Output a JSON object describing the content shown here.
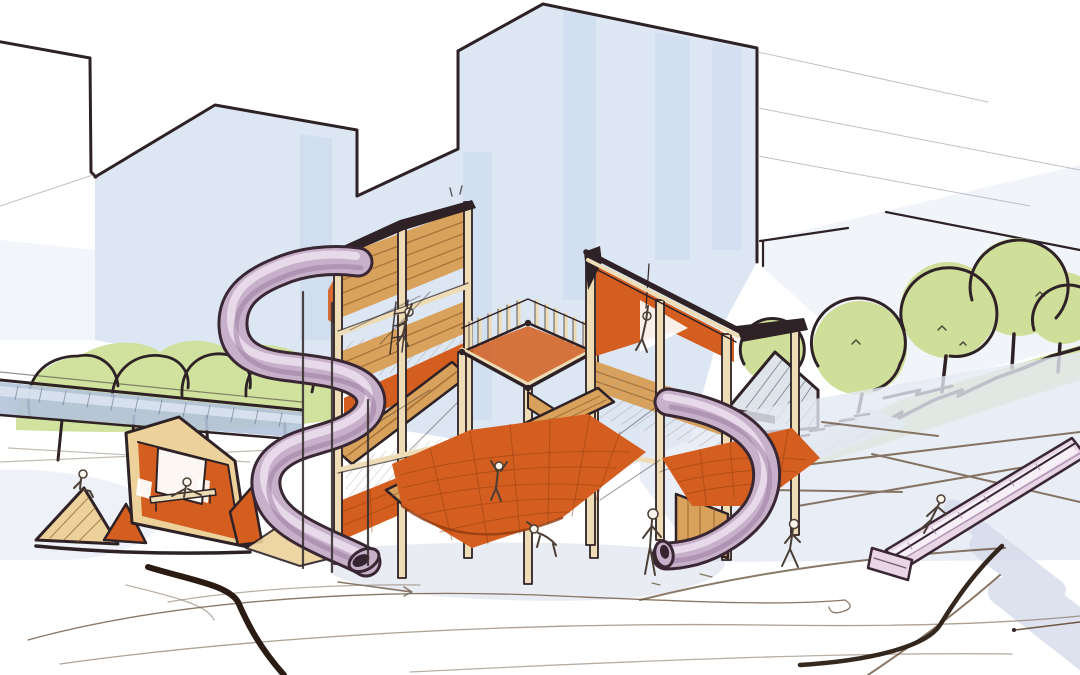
{
  "meta": {
    "title": "Playground concept sketch",
    "medium": "hand-drawn ink and marker rendering",
    "description": "Perspective concept sketch of a wooden playground: tall timber climbing towers with orange net ramps, a mauve S-shaped tube slide, a small angular playhouse with ramp, a footbridge, an embankment slide, rows of round green trees, stairs and terraced plaza, and pale blue city building silhouettes behind. Nine small children figures play throughout the scene.",
    "figures_count": 9
  },
  "scene": {
    "background": [
      "city-building-silhouettes",
      "blue-watercolor-wash",
      "perspective-guide-lines"
    ],
    "midground": [
      "left-tree-row",
      "footbridge",
      "right-tree-row",
      "green-bank",
      "pavilion-roof",
      "stairs",
      "plaza-contours"
    ],
    "foreground": [
      "playhouse",
      "climbing-towers",
      "net-ramps",
      "spiral-tube-slide",
      "curved-tube-slide",
      "embankment-slide",
      "children-figures",
      "ground-sketch-lines"
    ]
  },
  "colors": {
    "paper": "#ffffff",
    "ink": "#2e2226",
    "skyWash": "#dbe6f3",
    "skyStreak": "#c3d5ea",
    "faintLine": "#a293a0",
    "wood": "#d8a25c",
    "woodLight": "#ecd19b",
    "woodCream": "#eddcb5",
    "plankLine": "#8a5426",
    "orange": "#d45e1f",
    "netLine": "#8f3c10",
    "mauve": "#c7b0c9",
    "mauveLight": "#ece1ee",
    "mauveShade": "#97789d",
    "slideInk": "#392734",
    "slideHole": "#352531",
    "pinkSlide": "#e8d6e6",
    "treeGreen": "#cfdf99",
    "bankGreen": "#d5e3a4",
    "bridgeBlue": "#b3c3da",
    "bridgeBlueLight": "#dce5f1",
    "roofGrey": "#dfe3ea",
    "roofHatch": "#757b88",
    "groundWash": "#e3e8f2",
    "groundShadow": "#d6daea",
    "contour": "#6d5741",
    "contourDark": "#2a1c12",
    "figure": "#faf5ea",
    "figureLine": "#4b3f35",
    "hatchLine": "#a89a8e"
  }
}
